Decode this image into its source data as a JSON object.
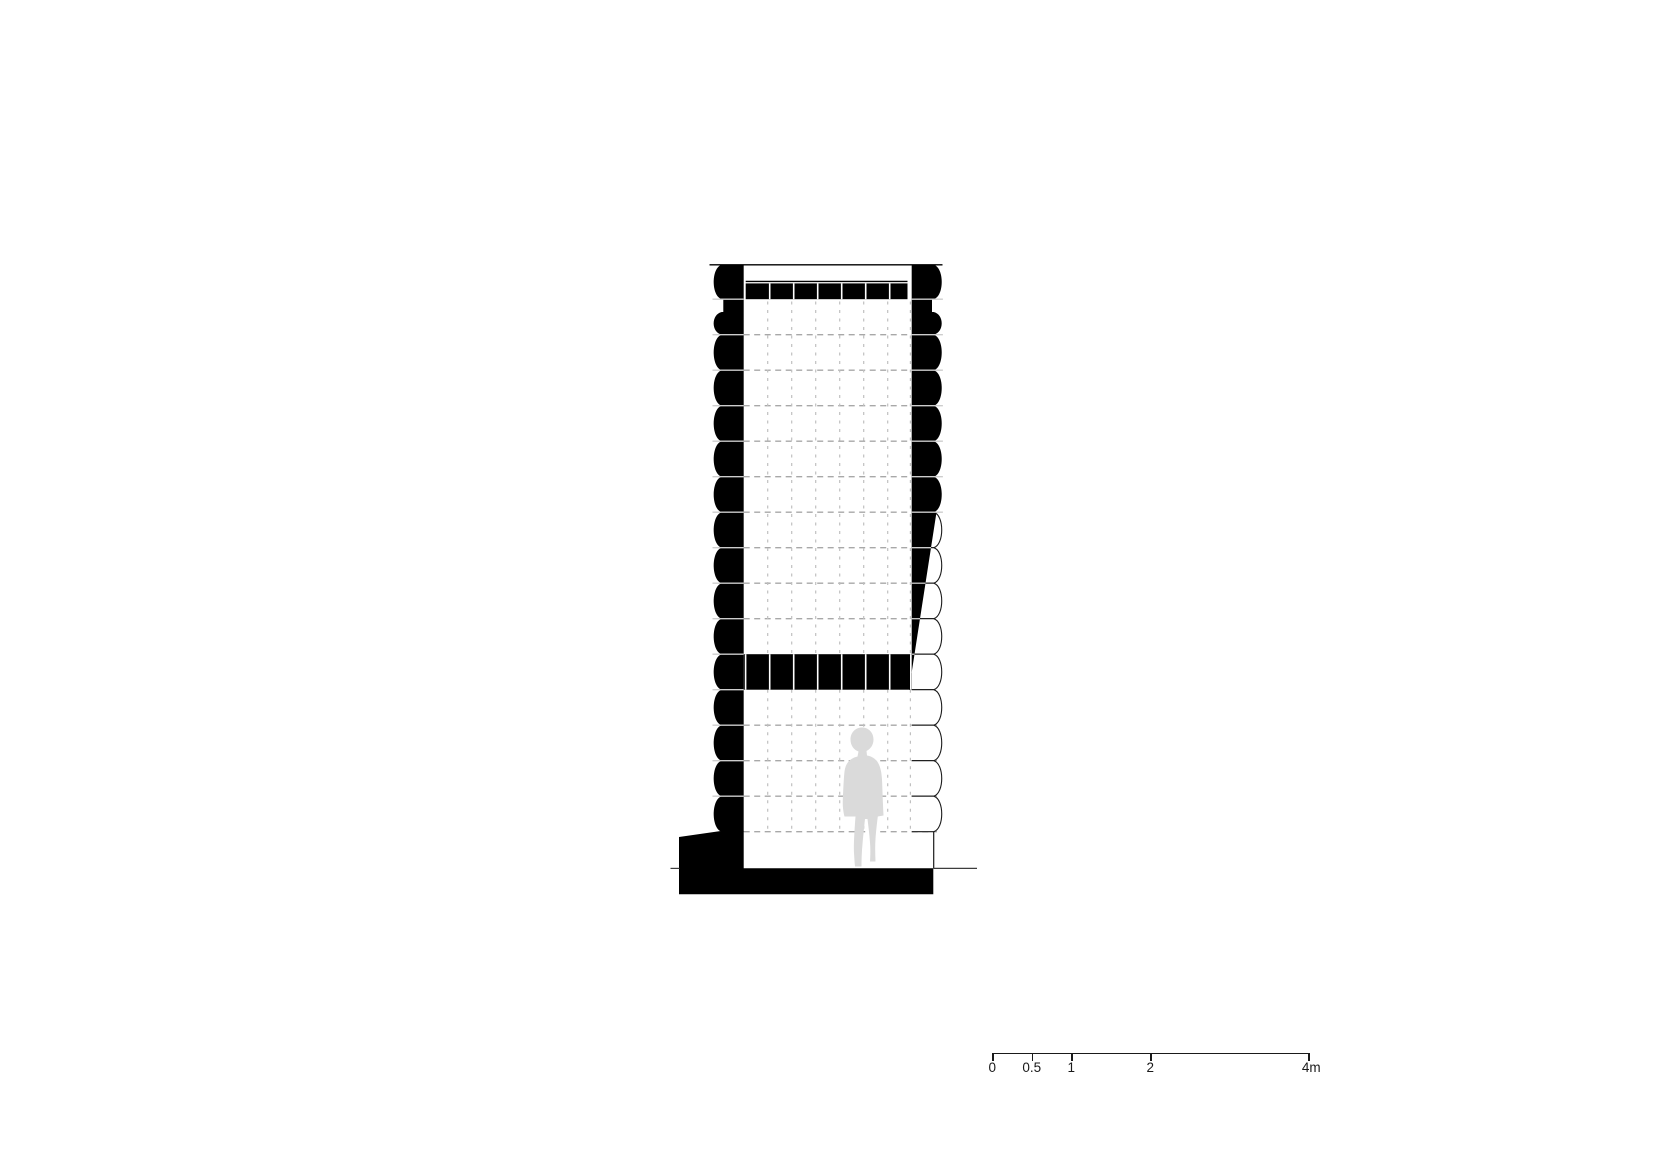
{
  "page": {
    "background": "#ffffff",
    "description": "Architectural cross-section drawing of a stacked-log structure on a concrete base, with dashed modular grid, a light grey human figure for scale, and a metric scale bar"
  },
  "drawing": {
    "canvas": {
      "width": 1654,
      "height": 1169
    },
    "module": {
      "top_y": 263.7,
      "course_height": 35.5,
      "courses": 16,
      "grid_step_x": 24
    },
    "left_wall": {
      "inner_face_x": 743.7,
      "chord_x": 721.7,
      "bulge_ctrl_x": 711.0,
      "notch_inset_x": 723.3,
      "notch_bottom_y": 312
    },
    "right_wall": {
      "inner_face_x": 911.7,
      "chord_x": 933.7,
      "bulge_ctrl_x": 944.4,
      "notch_inset_x": 932.0,
      "notch_bottom_y": 312,
      "solid_black_through_course": 6,
      "lower_edge_line": {
        "x": 933.7,
        "y1": 831.7,
        "y2": 868.3
      }
    },
    "roof": {
      "top_line": {
        "y": 264.8,
        "x1": 709.5,
        "x2": 942.5
      },
      "beam_line": {
        "y": 281.4,
        "x1": 745.7,
        "x2": 907.5
      },
      "beam": {
        "x1": 745.7,
        "x2": 907.5,
        "y1": 283.4,
        "y2": 299.2
      },
      "divider_xs": [
        769.7,
        793.7,
        817.7,
        841.7,
        865.7,
        889.7
      ]
    },
    "mid_band": {
      "y1": 654.2,
      "y2": 689.7,
      "x1": 743.7,
      "x2": 911.7,
      "divider_xs": [
        745.6,
        769.7,
        793.7,
        817.7,
        841.7,
        865.7,
        889.7,
        910.8
      ]
    },
    "wedge": {
      "face_x": 911.7,
      "top_y": 512.2,
      "top_x": 936.5,
      "bottom_y": 689.7,
      "bottom_x": 909.0
    },
    "grid": {
      "upper_h": {
        "x1": 743.7,
        "x2": 911.7,
        "first_course": 2,
        "last_course": 10
      },
      "lower_h": {
        "x1": 743.7,
        "x2": 937.0,
        "first_course": 13,
        "last_course": 16
      },
      "v_xs": [
        767.7,
        791.7,
        815.7,
        839.7,
        863.7,
        887.7,
        910.4
      ],
      "upper_v": {
        "y1": 301.5,
        "y2": 654.2
      },
      "lower_v": {
        "y1": 689.7,
        "y2": 832.0
      }
    },
    "foundation": {
      "points": [
        [
          679,
          837
        ],
        [
          721.7,
          830.9
        ],
        [
          743.7,
          830.9
        ],
        [
          743.7,
          868.3
        ],
        [
          933.3,
          868.3
        ],
        [
          933.3,
          894.3
        ],
        [
          679,
          894.3
        ]
      ]
    },
    "ground_lines": {
      "y": 868.4,
      "left": [
        670.5,
        679.5
      ],
      "right": [
        933.5,
        977.0
      ]
    },
    "figure": {
      "fill": "#dadada",
      "path": "M 862,727.5 C 855.5,727.5 850.5,732.5 850.5,739.5 C 850.5,745.5 854,750 858.5,751.5 L 857.5,756.5 C 849.5,758.5 845.5,763.5 844.5,771.5 C 843.8,778 843.2,790 842.8,800 C 842.5,807 843.5,813 844.5,816.5 L 855.5,816.5 C 854.5,830 853.5,845 854,853 C 854.3,858 854.6,862.5 855,866.5 L 861.5,866.5 C 861.5,859 861.8,851 862.5,844 C 863.2,836.5 864.2,826 865,819 L 867.5,819 C 868.5,827 869.8,838 870.2,845.5 C 870.5,851 870.3,857.5 870,861.5 L 875.5,861.5 C 875.2,854 875,846 875.5,839 C 876,831.5 877,823 877.8,816.5 L 883.5,815.5 C 883,805 882.5,793 882.2,784 C 882,775 881,766 876.5,760.5 C 873.5,757.5 870.5,756 867,755.5 L 866.5,751 C 870.5,749 873.5,745 873.5,739.5 C 873.5,732.5 868.5,727.5 862,727.5 Z"
    },
    "colors": {
      "ink": "#000000",
      "outline": "#1a1a1a",
      "joint_light": "#cdcdcd",
      "grid_h": "#a8a8a8",
      "grid_v": "#c0c0c0",
      "ground": "#3d3d3d"
    }
  },
  "scale_bar": {
    "x": 992.3,
    "y": 1052.7,
    "length_px": 316,
    "length_m": 4,
    "labels": [
      "0",
      "0.5",
      "1",
      "2",
      "4m"
    ],
    "marks_m": [
      0,
      0.5,
      1,
      2,
      4
    ],
    "tick_fracs": [
      0,
      0.125,
      0.25,
      0.5,
      1
    ]
  }
}
